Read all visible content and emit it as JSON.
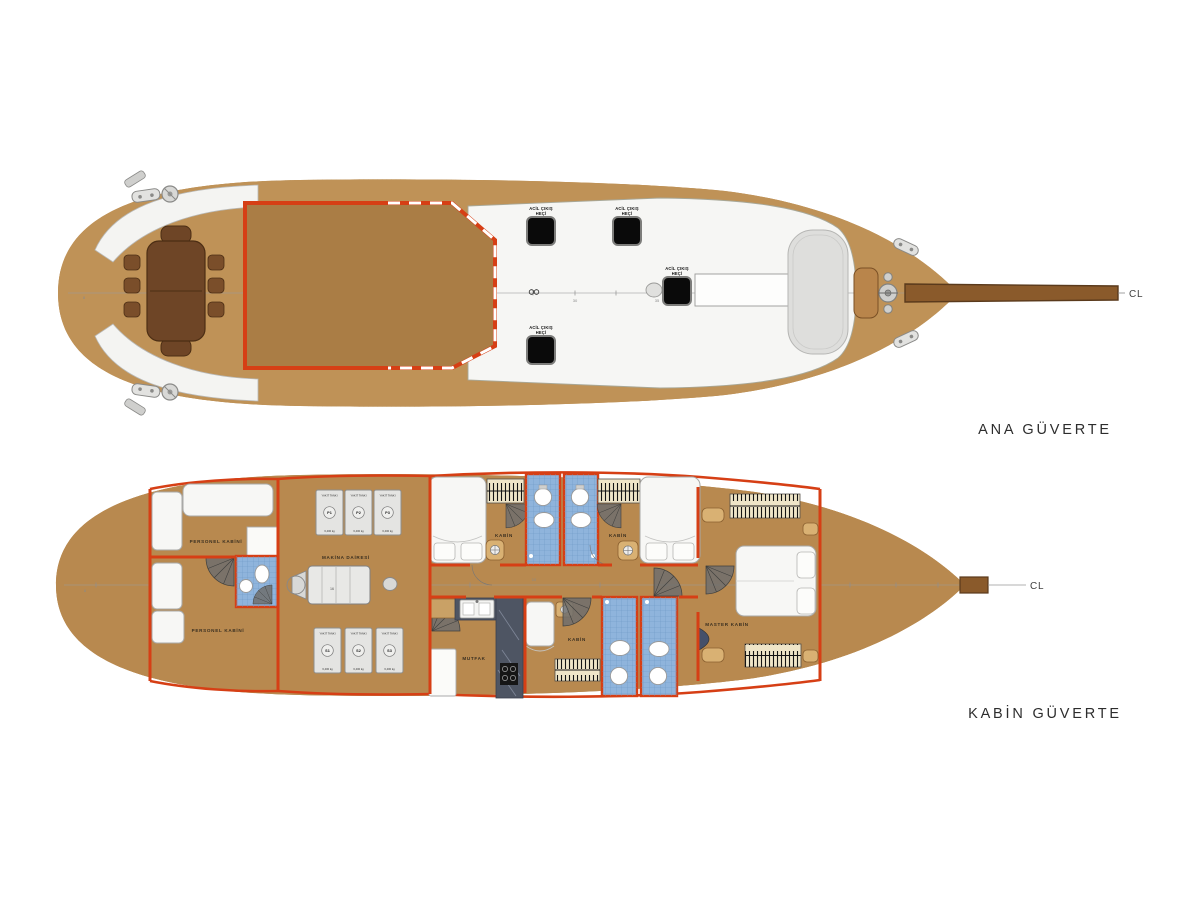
{
  "deck_plans": {
    "main_deck": {
      "title": "ANA GÜVERTE",
      "centerline": "CL",
      "frame_numbers": {
        "n30": "30",
        "n35": "35",
        "n40": "40",
        "stern": "8"
      },
      "labels": {
        "emergency_exit_line1": "ACİL ÇIKIŞ",
        "emergency_exit_line2": "HEÇİ",
        "beverage_line1": "İÇECEK",
        "beverage_line2": "DOLABI"
      }
    },
    "cabin_deck": {
      "title": "KABİN GÜVERTE",
      "centerline": "CL",
      "frame_numbers": {
        "corridor": "10",
        "engine": "16",
        "stern": "8"
      },
      "rooms": {
        "crew_cabin": "PERSONEL KABİNİ",
        "engine_room": "MAKİNA DAİRESİ",
        "guest_cabin": "KABİN",
        "galley": "MUTFAK",
        "master_cabin": "MASTER KABİN"
      },
      "fuel_tanks": {
        "name": "YAKIT TANKI",
        "capacity": "6,400 kg",
        "ids": [
          "P1",
          "P2",
          "P3",
          "S1",
          "S2",
          "S3"
        ]
      }
    }
  },
  "colors": {
    "hull_rim": "#5a3a1c",
    "deck_wood": "#bf9257",
    "accent_red": "#d63f15",
    "bath_blue": "#8fb4dc",
    "hatch_black": "#0a0a0a",
    "white_deck": "#f6f6f4"
  }
}
